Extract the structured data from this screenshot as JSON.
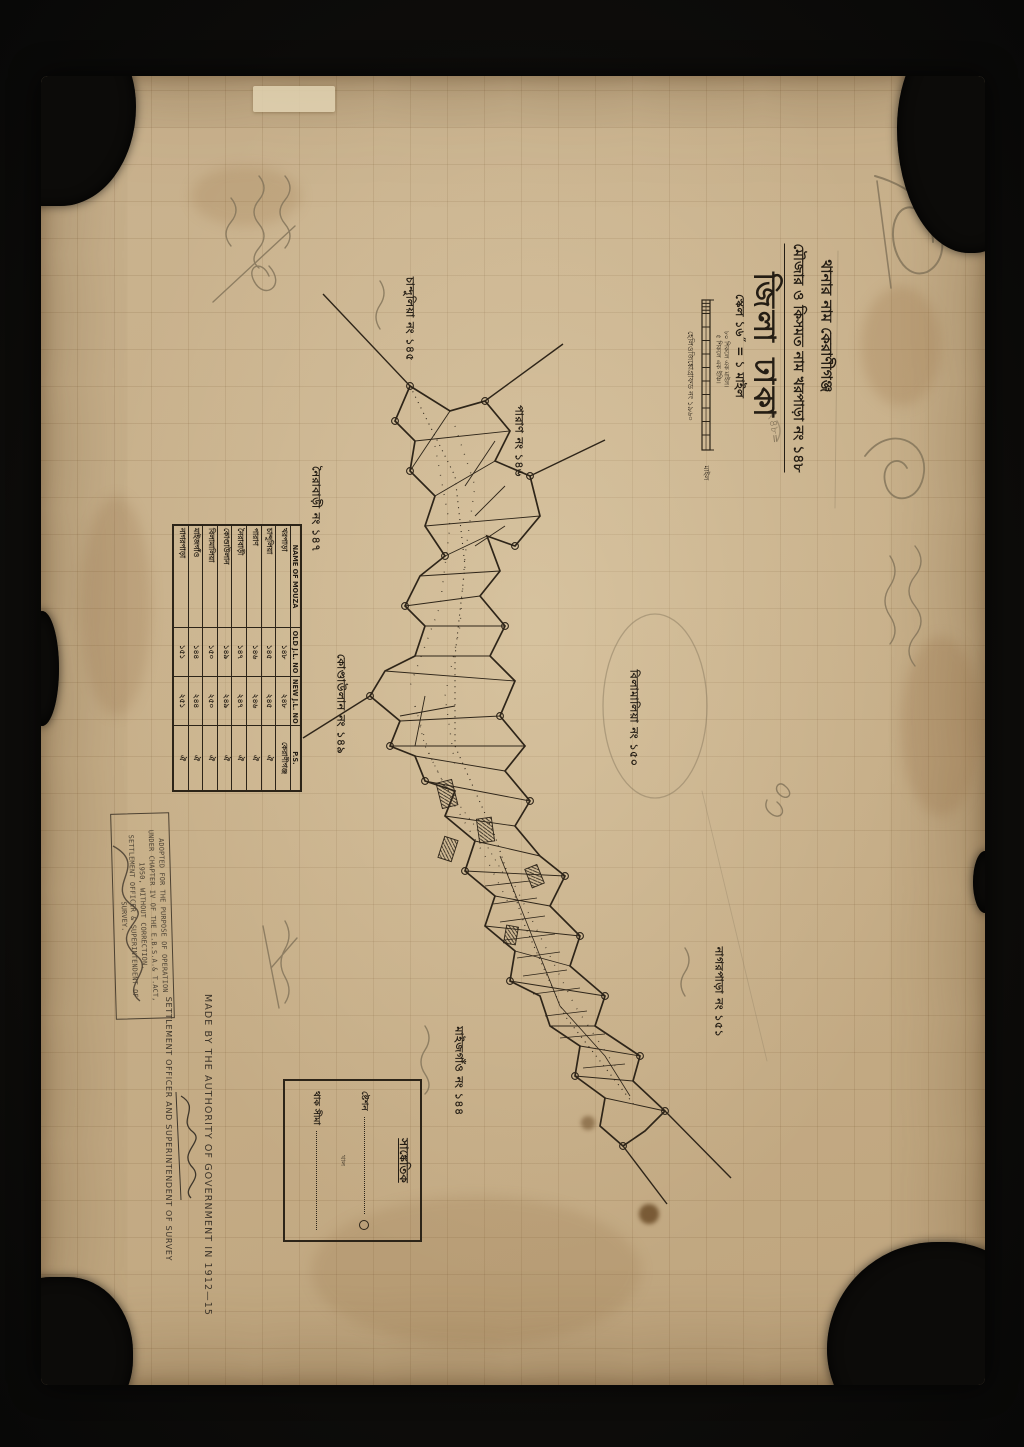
{
  "photo": {
    "backdrop_color": "#0d0c0a",
    "paper_color": "#c9b18c",
    "ink_color": "#241d14",
    "pencil_color": "#7e6f56"
  },
  "header": {
    "thana_line": "থানার নাম কেরাণীগঞ্জ",
    "mouza_line": "মৌজার ও কিসমত নাম খরপাড়া নং ১৪৮",
    "pencil_number": "২৪৮=",
    "district_title": "জিলা ঢাকা",
    "scale_line": "স্কেল ১৬˝ = ১ মাইল",
    "scale_note_1": "৮০ শিকলে এক মাইল।",
    "scale_note_2": "৫ শিকলে এক ইঞ্চি।",
    "scale_unit": "মাইল",
    "helio_line": "হেলিওজিঙ্কোগ্রাফড নং ১৯৬০"
  },
  "map_labels": [
    {
      "text": "চান্দুলিয়া নং ১৪৫"
    },
    {
      "text": "পারাণ নং ১৪৬"
    },
    {
      "text": "নৈরাবাড়ী নং ১৪৭"
    },
    {
      "text": "কোণ্ডাউলান নং ১৪৯"
    },
    {
      "text": "বিলামালিয়া নং ১৫০"
    },
    {
      "text": "নাগরপাড়া নং ১৫১"
    },
    {
      "text": "মাইজগাঁও নং ১৪৪"
    }
  ],
  "table": {
    "headers": [
      "NAME OF MOUZA",
      "OLD J.L. NO",
      "NEW J.L. NO",
      "P.S."
    ],
    "rows": [
      {
        "name": "খরপাড়া",
        "old": "১৪৮",
        "new": "২৪৮",
        "ps": "কেরাণীগঞ্জ"
      },
      {
        "name": "চান্দুলিয়া",
        "old": "১৪৫",
        "new": "২৪৫",
        "ps": "ঐ"
      },
      {
        "name": "পারাণ",
        "old": "১৪৬",
        "new": "২৪৬",
        "ps": "ঐ"
      },
      {
        "name": "নৈরাবাড়ী",
        "old": "১৪৭",
        "new": "২৪৭",
        "ps": "ঐ"
      },
      {
        "name": "কোণ্ডাউলান",
        "old": "১৪৯",
        "new": "২৪৯",
        "ps": "ঐ"
      },
      {
        "name": "বিলামালিয়া",
        "old": "১৫০",
        "new": "২৫০",
        "ps": "ঐ"
      },
      {
        "name": "মাইজগাঁও",
        "old": "১৪৪",
        "new": "২৪৪",
        "ps": "ঐ"
      },
      {
        "name": "নাগরপাড়া",
        "old": "১৫১",
        "new": "২৫১",
        "ps": "ঐ"
      }
    ]
  },
  "stamp": {
    "lines": [
      "ADOPTED FOR THE PURPOSE OF OPERATION",
      "UNDER CHAPTER IV OF THE E.B.S.A.& T.ACT,",
      "1950, WITHOUT CORRECTION.",
      "SETTLEMENT OFFICER & SUPERINTENDENT OF",
      "SURVEY."
    ]
  },
  "authority": {
    "made_by": "MADE BY THE AUTHORITY OF GOVERNMENT IN 1912—15",
    "officer": "SETTLEMENT OFFICER AND SUPERINTENDENT OF SURVEY"
  },
  "legend": {
    "title": "সাঙ্কেতিক",
    "entries": [
      {
        "label": "ষ্টেশন"
      },
      {
        "label": "থাক সীমা"
      }
    ],
    "note": "খাল"
  }
}
